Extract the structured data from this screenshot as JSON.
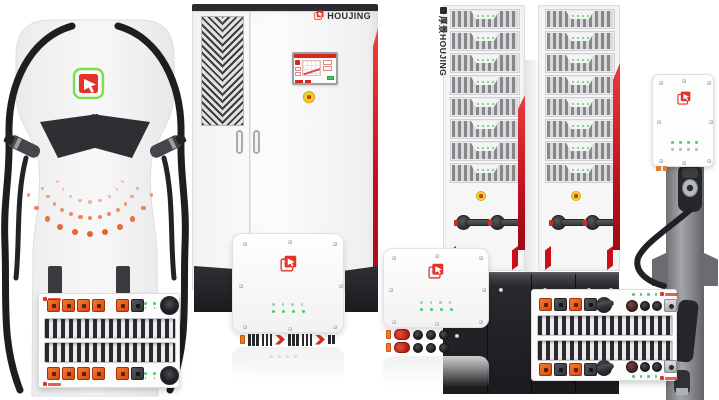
{
  "brand": {
    "name": "HOUJING",
    "vertical_label": "厚景HOUJING",
    "icon": "red-square-cursor-logo"
  },
  "palette": {
    "background": "#ffffff",
    "brand_red": "#e5332a",
    "stripe_red": "#c8101d",
    "logo_green": "#7ddc4f",
    "connector_orange": "#e65f1e",
    "led_green": "#49cf63",
    "led_green_dim": "#9fd6a8",
    "estop_yellow": "#f0cd25",
    "estop_red": "#c81f12",
    "cable_black": "#1d1e21",
    "cabinet_dark": "#2b2c2f",
    "plinth_dark": "#1b1b1f",
    "pole_gray": "#8e9093",
    "dot_orange": "#ec5e28"
  },
  "charger": {
    "dot_arcs": [
      {
        "count": 9,
        "radius": 36,
        "max_size": 3.4,
        "opacity": 0.45
      },
      {
        "count": 13,
        "radius": 52,
        "max_size": 4.6,
        "opacity": 0.75
      },
      {
        "count": 11,
        "radius": 68,
        "max_size": 6.2,
        "opacity": 1.0
      }
    ]
  },
  "cabinet": {
    "logo_text": "HOUJING",
    "has_touchscreen": true,
    "has_estop": true
  },
  "towers": {
    "count": 2,
    "module_rows": 8,
    "leds_per_module": 4,
    "switches_per_tower": 2,
    "label": "厚景HOUJING"
  },
  "wall_unit": {
    "led_top_count": 4,
    "led_bottom_count": 4
  },
  "rack_left": {
    "top_connectors": [
      "orange",
      "orange",
      "orange",
      "orange",
      "gap",
      "orange",
      "dark"
    ],
    "bottom_connectors": [
      "orange",
      "orange",
      "orange",
      "orange",
      "gap",
      "orange",
      "dark"
    ],
    "led_count": 4
  },
  "rack_right": {
    "left_connectors": [
      "orange",
      "dark",
      "orange",
      "dark"
    ],
    "right_connectors": [
      "maroon",
      "black",
      "black",
      "silver"
    ],
    "led_count": 4
  },
  "inverter_large": {
    "connector_row": [
      "orange-tab",
      "pins",
      "pins",
      "red-block",
      "pins",
      "pins",
      "red-block",
      "pins-small"
    ],
    "led_rows": 2,
    "leds_per_row": 4
  },
  "inverter_small": {
    "connector_row": [
      "orange-tab",
      "red-capsule",
      "black-round",
      "black-round",
      "black-round"
    ],
    "connector_rows": 2,
    "led_rows": 2,
    "leds_per_row": 4
  }
}
